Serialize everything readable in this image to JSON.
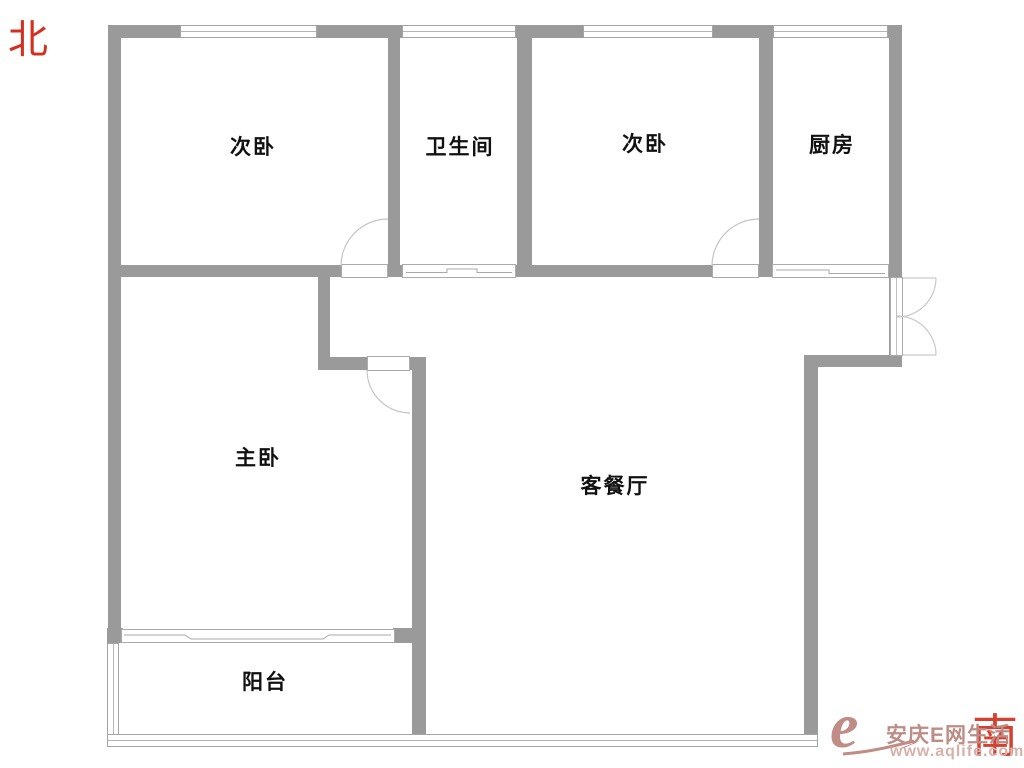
{
  "compass": {
    "north": "北",
    "south": "南"
  },
  "rooms": {
    "bedroom_nw": "次卧",
    "bathroom": "卫生间",
    "bedroom_ne": "次卧",
    "kitchen": "厨房",
    "master_bedroom": "主卧",
    "living_dining": "客餐厅",
    "balcony": "阳台"
  },
  "watermark": {
    "logo_letter": "e",
    "site_name": "安庆E网生活",
    "url": "www.aqlife.com"
  },
  "palette": {
    "wall_gray": "#9a9a9a",
    "door_arc_gray": "#c4c4c4",
    "compass_red": "#d3301f",
    "watermark_rose": "#c08c86",
    "watermark_url_pink": "#d8b0aa",
    "label_black": "#111111",
    "background": "#ffffff"
  }
}
